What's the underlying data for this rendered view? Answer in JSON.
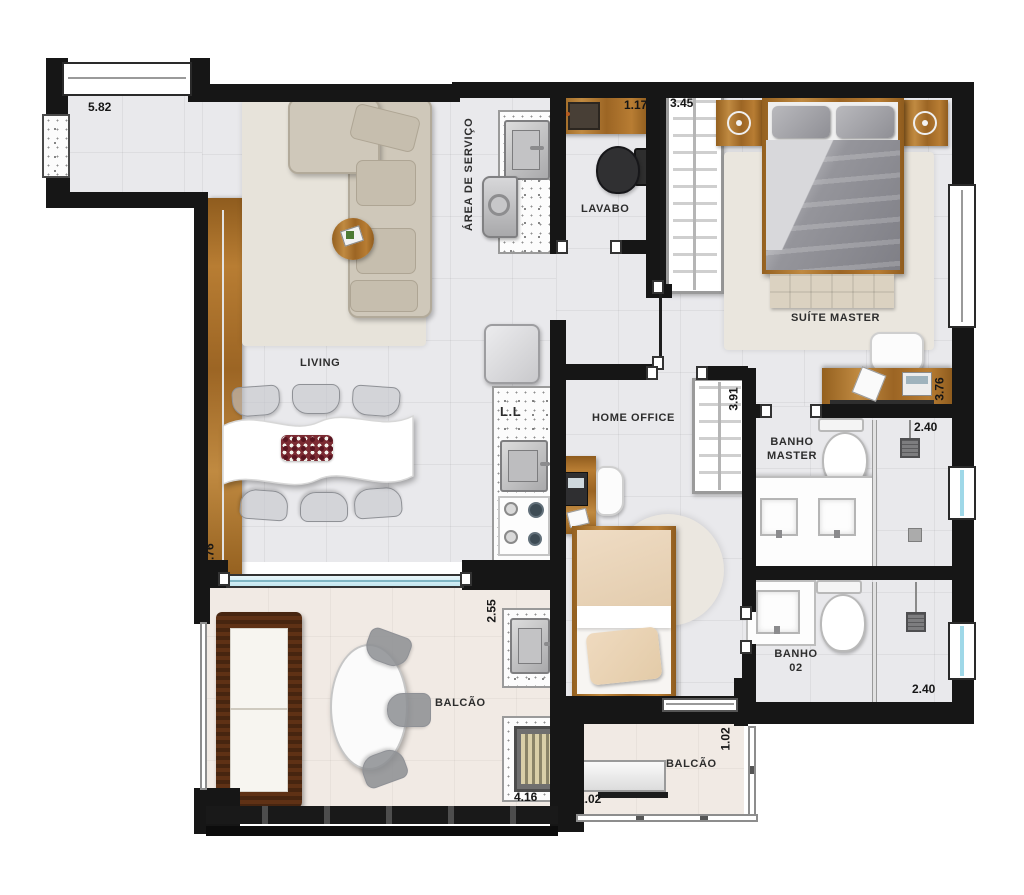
{
  "plan": {
    "type": "apartment-floor-plan",
    "rooms": {
      "area_servico": "ÁREA DE SERVIÇO",
      "lavabo": "LAVABO",
      "suite_master": "SUÍTE MASTER",
      "living": "LIVING",
      "home_office": "HOME OFFICE",
      "banho_master": "BANHO MASTER",
      "banho_02": "BANHO 02",
      "balcao_1": "BALCÃO",
      "balcao_2": "BALCÃO",
      "dishwasher": "L.L"
    },
    "dimensions": {
      "corridor_width": "5.82",
      "lavabo_width": "1.17",
      "suite_closet_width": "3.45",
      "lavabo_depth": "1.74",
      "suite_desk_width": "3.76",
      "banho_master_entry": "1.80",
      "banho_master_shower": "2.40",
      "office_wardrobe": "3.91",
      "office_width": "2.21",
      "balcao_depth": "2.55",
      "living_depth": "5.76",
      "banho_02_entry": "1.55",
      "banho_02_shower": "2.40",
      "balcao_width": "4.16",
      "balcao_2_bench": "2.02",
      "balcao_2_depth": "1.02"
    },
    "colors": {
      "wall": "#161616",
      "floor": "#e9e9ec",
      "balcony_floor": "#f1eae4",
      "wood": "#a96f2c",
      "glass": "#c2e6ef"
    }
  }
}
